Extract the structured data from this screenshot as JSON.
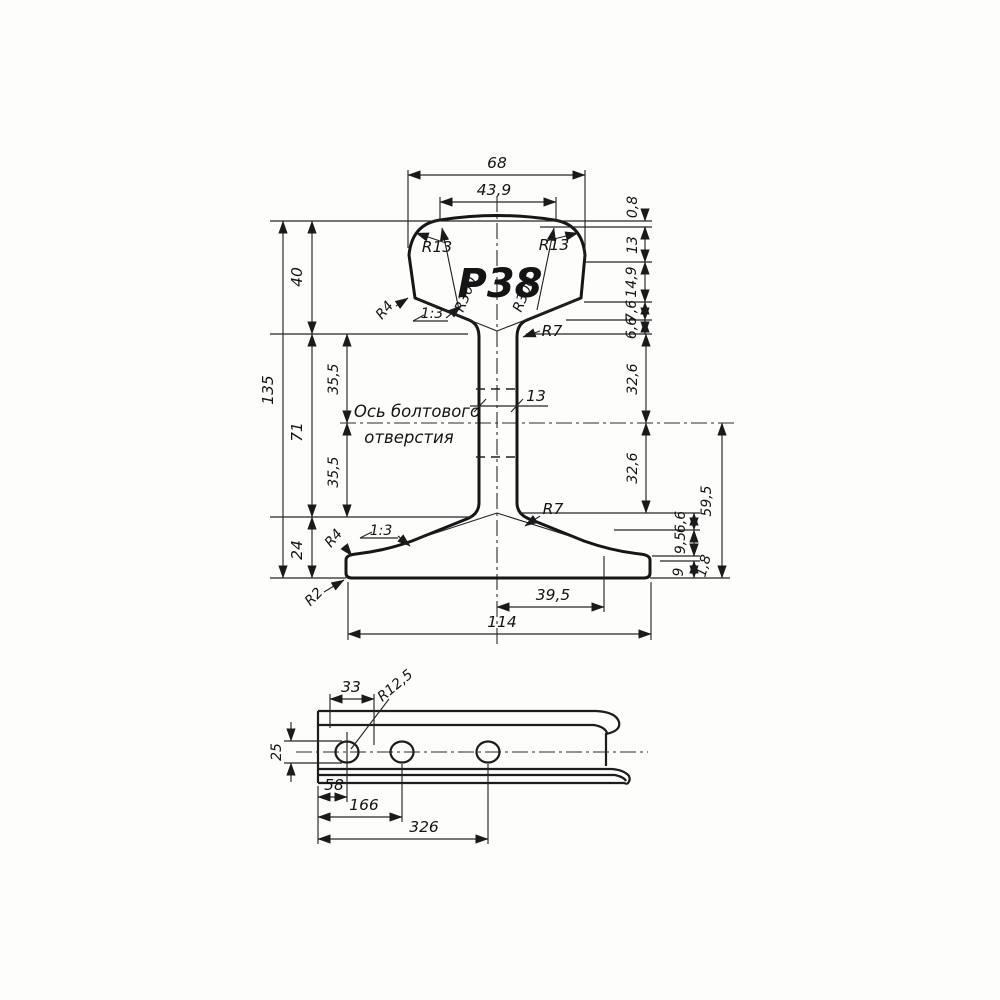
{
  "page": {
    "background": "#fdfdfc",
    "line_color": "#1c1c1c"
  },
  "drawing": {
    "kind": "rail-profile-technical-drawing",
    "cross_section": {
      "profile_name": "Р38",
      "dims": {
        "head_width": "68",
        "crown_width": "43,9",
        "crown_rise": "0,8",
        "head_seg_13": "13",
        "head_seg_14_9": "14,9",
        "head_seg_7_6": "7,6",
        "head_seg_6_6": "6,6",
        "head_height": "40",
        "total_height": "135",
        "web_height": "71",
        "web_half_upper": "35,5",
        "web_half_lower": "35,5",
        "web_thickness": "13",
        "axis_up_32_6": "32,6",
        "axis_down_32_6": "32,6",
        "axis_to_bottom": "59,5",
        "foot_height": "24",
        "foot_seg_6_6": "6,6",
        "foot_seg_9_5": "9,5",
        "foot_tip_1_8": "1,8",
        "foot_edge_9": "9",
        "foot_half_width": "39,5",
        "foot_width": "114"
      },
      "radii": {
        "r13_left": "R13",
        "r13_right": "R13",
        "r300_left": "R300",
        "r300_right": "R300",
        "r4_head": "R4",
        "r4_foot": "R4",
        "r7_web_top": "R7",
        "r7_web_bottom": "R7",
        "r2_foot": "R2"
      },
      "slope_head": "1:3",
      "slope_foot": "1:3",
      "axis_note_line1": "Ось болтового",
      "axis_note_line2": "отверстия"
    },
    "side_view": {
      "dims": {
        "end_to_hole_area": "33",
        "hole_radius": "R12,5",
        "hole_height": "25",
        "hole1_from_end": "58",
        "hole2_from_end": "166",
        "hole3_from_end": "326"
      }
    }
  }
}
